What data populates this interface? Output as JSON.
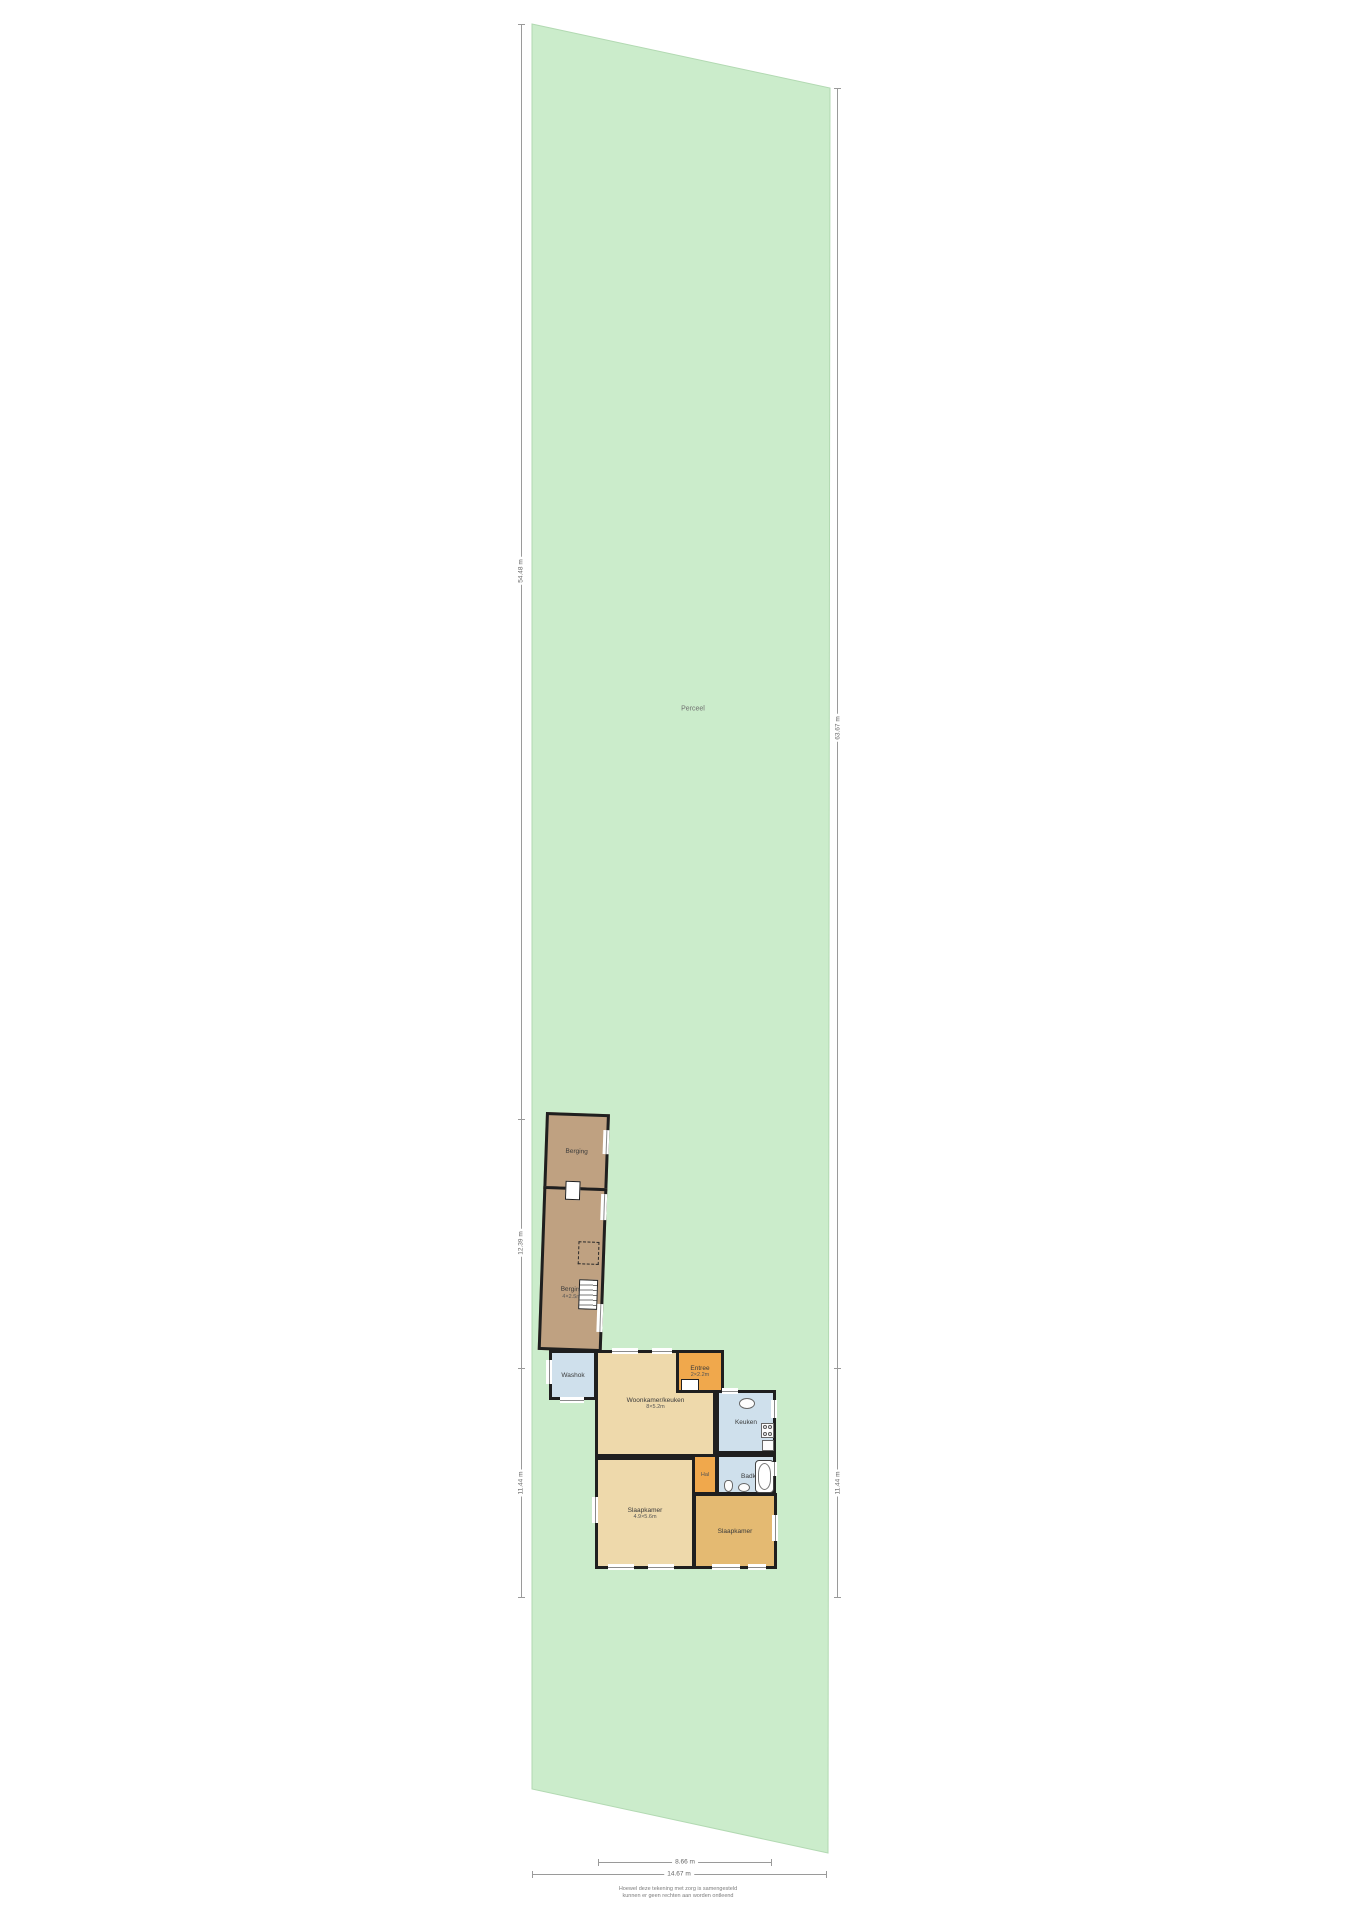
{
  "drawing": {
    "type": "situatie-plattegrond",
    "plot_label": "Perceel"
  },
  "dimensions": {
    "left": [
      "54.48 m",
      "12.39 m",
      "11.44 m"
    ],
    "right": [
      "63.67 m",
      "11.44 m"
    ],
    "bottom_inner": "8.66 m",
    "bottom_outer": "14.67 m"
  },
  "rooms": {
    "berging_top": {
      "label": "Berging"
    },
    "berging_bottom": {
      "label": "Berging",
      "size": "4×2.5m"
    },
    "washok": {
      "label": "Washok"
    },
    "entree": {
      "label": "Entree",
      "size": "2×2.2m"
    },
    "woonkamer": {
      "label": "Woonkamer/keuken",
      "size": "8×5.2m"
    },
    "keuken": {
      "label": "Keuken"
    },
    "kast": {
      "label": "Kast"
    },
    "hal": {
      "label": "Hal"
    },
    "badkamer": {
      "label": "Badkamer"
    },
    "slaapkamer_links": {
      "label": "Slaapkamer",
      "size": "4.9×5.6m"
    },
    "slaapkamer_rechts": {
      "label": "Slaapkamer"
    }
  },
  "footer": {
    "line1": "Hoewel deze tekening met zorg is samengesteld",
    "line2": "kunnen er geen rechten aan worden ontleend"
  },
  "colors": {
    "plot_fill": "#cbeccb",
    "plot_edge": "#b2d9b2",
    "barn": "#bfa181",
    "room_tan": "#eed9ab",
    "room_tan_dark": "#e4ba72",
    "room_orange": "#f0a84c",
    "room_blue": "#cfe0ec",
    "kast_brown": "#c0925c",
    "wall": "#1f1f1f",
    "dimension_line": "#9a9a9a"
  }
}
